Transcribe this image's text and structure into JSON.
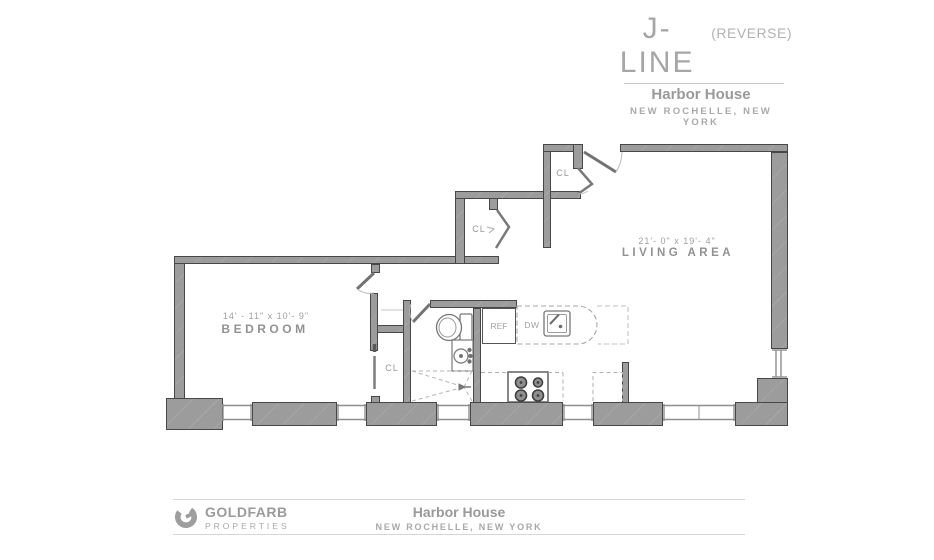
{
  "title_block": {
    "plan_name": "J-LINE",
    "plan_variant": "(REVERSE)",
    "building": "Harbor House",
    "location": "NEW ROCHELLE, NEW YORK"
  },
  "floor_plan": {
    "bedroom": {
      "dimensions": "14' - 11\" x 10'- 9\"",
      "label": "BEDROOM"
    },
    "living_area": {
      "dimensions": "21'- 0\" x 19'- 4\"",
      "label": "LIVING AREA"
    },
    "closet_label": "CL",
    "refrigerator_label": "REF",
    "dishwasher_label": "DW"
  },
  "footer": {
    "company_name": "GOLDFARB",
    "company_subtitle": "PROPERTIES",
    "building": "Harbor House",
    "location": "NEW ROCHELLE, NEW YORK"
  },
  "colors": {
    "wall": "#9c9c9c",
    "wall_edge": "#474747",
    "text": "#9a9a9a"
  }
}
